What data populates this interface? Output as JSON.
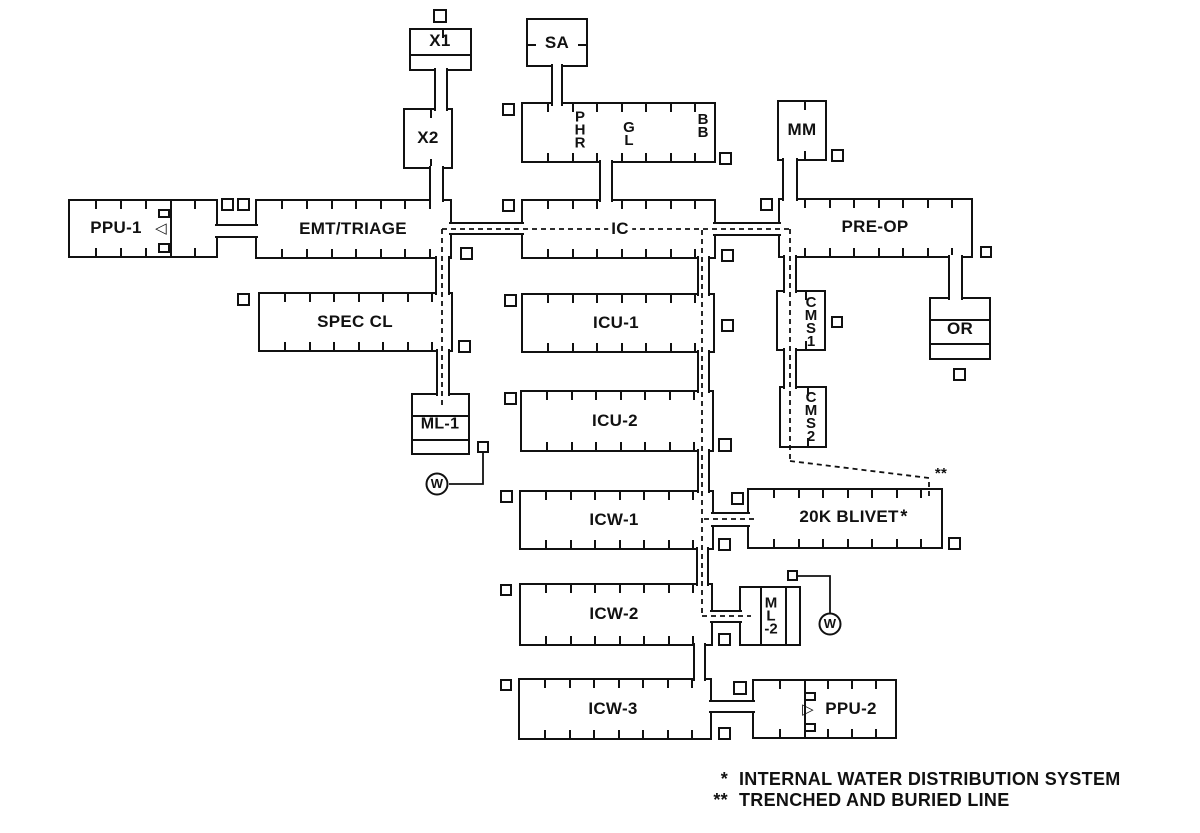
{
  "legend": {
    "items": [
      {
        "symbol": "*",
        "text": "INTERNAL WATER DISTRIBUTION SYSTEM"
      },
      {
        "symbol": "**",
        "text": "TRENCHED AND BURIED LINE"
      }
    ]
  },
  "diagram": {
    "units": [
      {
        "id": "ppu-1",
        "x": 68,
        "y": 199,
        "w": 150,
        "h": 59,
        "ticks": {
          "top": [
            25,
            50,
            75,
            124
          ],
          "bottom": [
            25,
            50,
            75,
            124
          ]
        },
        "internals": [
          {
            "t": "v",
            "x": 100
          },
          {
            "t": "r",
            "x": 88,
            "y": 8,
            "w": 12,
            "h": 9
          },
          {
            "t": "r",
            "x": 88,
            "y": 42,
            "w": 12,
            "h": 10
          }
        ]
      },
      {
        "id": "emt-triage",
        "x": 255,
        "y": 199,
        "w": 197,
        "h": 60,
        "ticks": {
          "top": [
            24,
            49,
            74,
            98,
            123,
            147,
            172
          ],
          "bottom": [
            24,
            49,
            74,
            98,
            123,
            147,
            172
          ]
        }
      },
      {
        "id": "ic",
        "x": 521,
        "y": 199,
        "w": 195,
        "h": 60,
        "ticks": {
          "top": [
            24,
            49,
            73,
            98,
            122,
            147,
            171
          ],
          "bottom": [
            24,
            49,
            73,
            98,
            122,
            147,
            171
          ]
        }
      },
      {
        "id": "pre-op",
        "x": 778,
        "y": 198,
        "w": 195,
        "h": 60,
        "ticks": {
          "top": [
            24,
            49,
            73,
            98,
            122,
            147,
            171
          ],
          "bottom": [
            24,
            49,
            73,
            98,
            122,
            147,
            171
          ]
        }
      },
      {
        "id": "phr-gl-bb",
        "x": 521,
        "y": 102,
        "w": 195,
        "h": 61,
        "ticks": {
          "top": [
            24,
            49,
            73,
            98,
            122,
            147,
            171
          ],
          "bottom": [
            24,
            49,
            73,
            98,
            122,
            147,
            171
          ]
        }
      },
      {
        "id": "spec-cl",
        "x": 258,
        "y": 292,
        "w": 195,
        "h": 60,
        "ticks": {
          "top": [
            24,
            49,
            73,
            98,
            122,
            147,
            171
          ],
          "bottom": [
            24,
            49,
            73,
            98,
            122,
            147,
            171
          ]
        }
      },
      {
        "id": "icu-1",
        "x": 521,
        "y": 293,
        "w": 194,
        "h": 60,
        "ticks": {
          "top": [
            24,
            49,
            73,
            98,
            122,
            147,
            171
          ],
          "bottom": [
            24,
            49,
            73,
            98,
            122,
            147,
            171
          ]
        }
      },
      {
        "id": "icu-2",
        "x": 520,
        "y": 390,
        "w": 194,
        "h": 62,
        "ticks": {
          "top": [
            24,
            49,
            73,
            98,
            122,
            147,
            171
          ],
          "bottom": [
            24,
            49,
            73,
            98,
            122,
            147,
            171
          ]
        }
      },
      {
        "id": "icw-1",
        "x": 519,
        "y": 490,
        "w": 195,
        "h": 60,
        "ticks": {
          "top": [
            24,
            49,
            73,
            98,
            122,
            147,
            171
          ],
          "bottom": [
            24,
            49,
            73,
            98,
            122,
            147,
            171
          ]
        }
      },
      {
        "id": "icw-2",
        "x": 519,
        "y": 583,
        "w": 194,
        "h": 63,
        "ticks": {
          "top": [
            24,
            49,
            73,
            98,
            122,
            147,
            171
          ],
          "bottom": [
            24,
            49,
            73,
            98,
            122,
            147,
            171
          ]
        }
      },
      {
        "id": "icw-3",
        "x": 518,
        "y": 678,
        "w": 194,
        "h": 62,
        "ticks": {
          "top": [
            24,
            49,
            73,
            98,
            122,
            147,
            171
          ],
          "bottom": [
            24,
            49,
            73,
            98,
            122,
            147,
            171
          ]
        }
      },
      {
        "id": "20k-blivet",
        "x": 747,
        "y": 488,
        "w": 196,
        "h": 61,
        "ticks": {
          "top": [
            24,
            49,
            73,
            98,
            122,
            147,
            171
          ],
          "bottom": [
            24,
            49,
            73,
            98,
            122,
            147,
            171
          ]
        }
      },
      {
        "id": "ppu-2",
        "x": 752,
        "y": 679,
        "w": 145,
        "h": 60,
        "ticks": {
          "top": [
            25,
            73,
            97,
            121
          ],
          "bottom": [
            25,
            73,
            97,
            121
          ]
        },
        "internals": [
          {
            "t": "v",
            "x": 50
          },
          {
            "t": "r",
            "x": 50,
            "y": 11,
            "w": 12,
            "h": 9
          },
          {
            "t": "r",
            "x": 50,
            "y": 42,
            "w": 12,
            "h": 9
          }
        ]
      },
      {
        "id": "x1",
        "x": 409,
        "y": 28,
        "w": 63,
        "h": 43,
        "ticks": {
          "top": [
            31
          ]
        },
        "internals": [
          {
            "t": "h",
            "y": 24
          }
        ]
      },
      {
        "id": "x2",
        "x": 403,
        "y": 108,
        "w": 50,
        "h": 61,
        "ticks": {
          "top": [
            25
          ],
          "bottom": [
            25
          ]
        }
      },
      {
        "id": "sa",
        "x": 526,
        "y": 18,
        "w": 62,
        "h": 49,
        "ticks": {
          "left": [
            24
          ],
          "right": [
            24
          ]
        }
      },
      {
        "id": "mm",
        "x": 777,
        "y": 100,
        "w": 50,
        "h": 61,
        "ticks": {
          "top": [
            25
          ],
          "bottom": [
            25
          ]
        }
      },
      {
        "id": "or",
        "x": 929,
        "y": 297,
        "w": 62,
        "h": 63,
        "internals": [
          {
            "t": "h",
            "y": 20
          },
          {
            "t": "h",
            "y": 44
          }
        ]
      },
      {
        "id": "ml-1",
        "x": 411,
        "y": 393,
        "w": 59,
        "h": 62,
        "internals": [
          {
            "t": "h",
            "y": 20
          },
          {
            "t": "h",
            "y": 44
          }
        ]
      },
      {
        "id": "cms1",
        "x": 776,
        "y": 290,
        "w": 50,
        "h": 61,
        "ticks": {
          "top": [
            27
          ],
          "bottom": [
            27
          ]
        }
      },
      {
        "id": "cms2",
        "x": 779,
        "y": 386,
        "w": 48,
        "h": 62,
        "ticks": {
          "top": [
            26
          ],
          "bottom": [
            26
          ]
        }
      },
      {
        "id": "ml-2",
        "x": 739,
        "y": 586,
        "w": 62,
        "h": 60,
        "internals": [
          {
            "t": "v",
            "x": 19
          },
          {
            "t": "v",
            "x": 44
          }
        ]
      }
    ],
    "corridors": [
      {
        "o": "h",
        "x": 215,
        "y": 224,
        "w": 43,
        "h": 14
      },
      {
        "o": "h",
        "x": 449,
        "y": 222,
        "w": 75,
        "h": 13
      },
      {
        "o": "h",
        "x": 713,
        "y": 222,
        "w": 68,
        "h": 14
      },
      {
        "o": "v",
        "x": 599,
        "y": 160,
        "w": 14,
        "h": 42
      },
      {
        "o": "v",
        "x": 551,
        "y": 64,
        "w": 12,
        "h": 42
      },
      {
        "o": "v",
        "x": 434,
        "y": 68,
        "w": 14,
        "h": 43
      },
      {
        "o": "v",
        "x": 429,
        "y": 166,
        "w": 15,
        "h": 36
      },
      {
        "o": "v",
        "x": 782,
        "y": 158,
        "w": 16,
        "h": 43
      },
      {
        "o": "v",
        "x": 435,
        "y": 256,
        "w": 15,
        "h": 39
      },
      {
        "o": "v",
        "x": 436,
        "y": 349,
        "w": 14,
        "h": 47
      },
      {
        "o": "v",
        "x": 783,
        "y": 255,
        "w": 14,
        "h": 38
      },
      {
        "o": "v",
        "x": 783,
        "y": 348,
        "w": 14,
        "h": 41
      },
      {
        "o": "v",
        "x": 697,
        "y": 256,
        "w": 13,
        "h": 40
      },
      {
        "o": "v",
        "x": 697,
        "y": 350,
        "w": 13,
        "h": 43
      },
      {
        "o": "v",
        "x": 697,
        "y": 449,
        "w": 13,
        "h": 44
      },
      {
        "o": "v",
        "x": 696,
        "y": 547,
        "w": 13,
        "h": 39
      },
      {
        "o": "v",
        "x": 693,
        "y": 643,
        "w": 13,
        "h": 38
      },
      {
        "o": "h",
        "x": 711,
        "y": 512,
        "w": 39,
        "h": 15
      },
      {
        "o": "h",
        "x": 710,
        "y": 610,
        "w": 32,
        "h": 13
      },
      {
        "o": "h",
        "x": 709,
        "y": 700,
        "w": 46,
        "h": 13
      },
      {
        "o": "v",
        "x": 948,
        "y": 255,
        "w": 15,
        "h": 45
      }
    ],
    "squares": [
      [
        433,
        9,
        14
      ],
      [
        502,
        103,
        13
      ],
      [
        719,
        152,
        13
      ],
      [
        831,
        149,
        13
      ],
      [
        221,
        198,
        13
      ],
      [
        237,
        198,
        13
      ],
      [
        460,
        247,
        13
      ],
      [
        502,
        199,
        13
      ],
      [
        721,
        249,
        13
      ],
      [
        760,
        198,
        13
      ],
      [
        980,
        246,
        12
      ],
      [
        237,
        293,
        13
      ],
      [
        458,
        340,
        13
      ],
      [
        504,
        294,
        13
      ],
      [
        721,
        319,
        13
      ],
      [
        831,
        316,
        12
      ],
      [
        953,
        368,
        13
      ],
      [
        504,
        392,
        13
      ],
      [
        718,
        438,
        14
      ],
      [
        500,
        490,
        13
      ],
      [
        731,
        492,
        13
      ],
      [
        718,
        538,
        13
      ],
      [
        948,
        537,
        13
      ],
      [
        500,
        584,
        12
      ],
      [
        718,
        633,
        13
      ],
      [
        500,
        679,
        12
      ],
      [
        733,
        681,
        14
      ],
      [
        718,
        727,
        13
      ],
      [
        477,
        441,
        12
      ],
      [
        787,
        570,
        11
      ]
    ],
    "water_dashed": [
      "M442 229 H790",
      "M442 229 V406",
      "M790 229 V461",
      "M790 461 L929 478 V500",
      "M702 230 V616",
      "M704 519 H758",
      "M702 616 H751"
    ],
    "hookup_lines": [
      "M483 453 V484 H449",
      "M798 576 H830 V613"
    ],
    "water_points": [
      {
        "x": 437,
        "y": 484
      },
      {
        "x": 830,
        "y": 624
      }
    ],
    "labels": [
      {
        "text": "PPU-1",
        "x": 116,
        "y": 228,
        "name": "label-ppu-1"
      },
      {
        "text": "EMT/TRIAGE",
        "x": 353,
        "y": 229,
        "name": "label-emt-triage"
      },
      {
        "text": "IC",
        "x": 620,
        "y": 229,
        "bg": true,
        "name": "label-ic"
      },
      {
        "text": "PRE-OP",
        "x": 875,
        "y": 227,
        "name": "label-pre-op"
      },
      {
        "text": "P\nH\nR",
        "x": 580,
        "y": 130,
        "stack": true,
        "name": "label-phr"
      },
      {
        "text": "G\nL",
        "x": 629,
        "y": 134,
        "stack": true,
        "name": "label-gl"
      },
      {
        "text": "B\nB",
        "x": 703,
        "y": 126,
        "stack": true,
        "name": "label-bb"
      },
      {
        "text": "SPEC CL",
        "x": 355,
        "y": 322,
        "name": "label-spec-cl"
      },
      {
        "text": "ICU-1",
        "x": 616,
        "y": 323,
        "name": "label-icu-1"
      },
      {
        "text": "ICU-2",
        "x": 615,
        "y": 421,
        "name": "label-icu-2"
      },
      {
        "text": "ICW-1",
        "x": 614,
        "y": 520,
        "name": "label-icw-1"
      },
      {
        "text": "ICW-2",
        "x": 614,
        "y": 614,
        "name": "label-icw-2"
      },
      {
        "text": "ICW-3",
        "x": 613,
        "y": 709,
        "name": "label-icw-3"
      },
      {
        "text": "20K BLIVET",
        "x": 849,
        "y": 517,
        "name": "label-20k-blivet"
      },
      {
        "text": "PPU-2",
        "x": 851,
        "y": 709,
        "name": "label-ppu-2"
      },
      {
        "text": "X1",
        "x": 440,
        "y": 41,
        "name": "label-x1"
      },
      {
        "text": "X2",
        "x": 428,
        "y": 138,
        "name": "label-x2"
      },
      {
        "text": "SA",
        "x": 557,
        "y": 43,
        "name": "label-sa"
      },
      {
        "text": "MM",
        "x": 802,
        "y": 130,
        "name": "label-mm"
      },
      {
        "text": "OR",
        "x": 960,
        "y": 329,
        "name": "label-or"
      },
      {
        "text": "ML-1",
        "x": 440,
        "y": 425,
        "size": 16,
        "name": "label-ml-1"
      },
      {
        "text": "C\nM\nS\n1",
        "x": 811,
        "y": 322,
        "stack": true,
        "name": "label-cms1"
      },
      {
        "text": "C\nM\nS\n2",
        "x": 811,
        "y": 417,
        "stack": true,
        "name": "label-cms2"
      },
      {
        "text": "M\nL\n-2",
        "x": 771,
        "y": 616,
        "stack": true,
        "name": "label-ml-2"
      },
      {
        "text": "◁",
        "x": 161,
        "y": 229,
        "size": 15,
        "name": "generator-symbol-left"
      },
      {
        "text": "▷",
        "x": 808,
        "y": 710,
        "size": 15,
        "name": "generator-symbol-right"
      },
      {
        "text": "W",
        "x": 437,
        "y": 484,
        "size": 13,
        "name": "water-point-letter"
      },
      {
        "text": "W",
        "x": 830,
        "y": 624,
        "size": 13,
        "name": "water-point-letter"
      },
      {
        "text": "**",
        "x": 941,
        "y": 474,
        "size": 15,
        "name": "marker-double-star"
      },
      {
        "text": "*",
        "x": 904,
        "y": 517,
        "size": 18,
        "name": "marker-single-star"
      }
    ]
  }
}
